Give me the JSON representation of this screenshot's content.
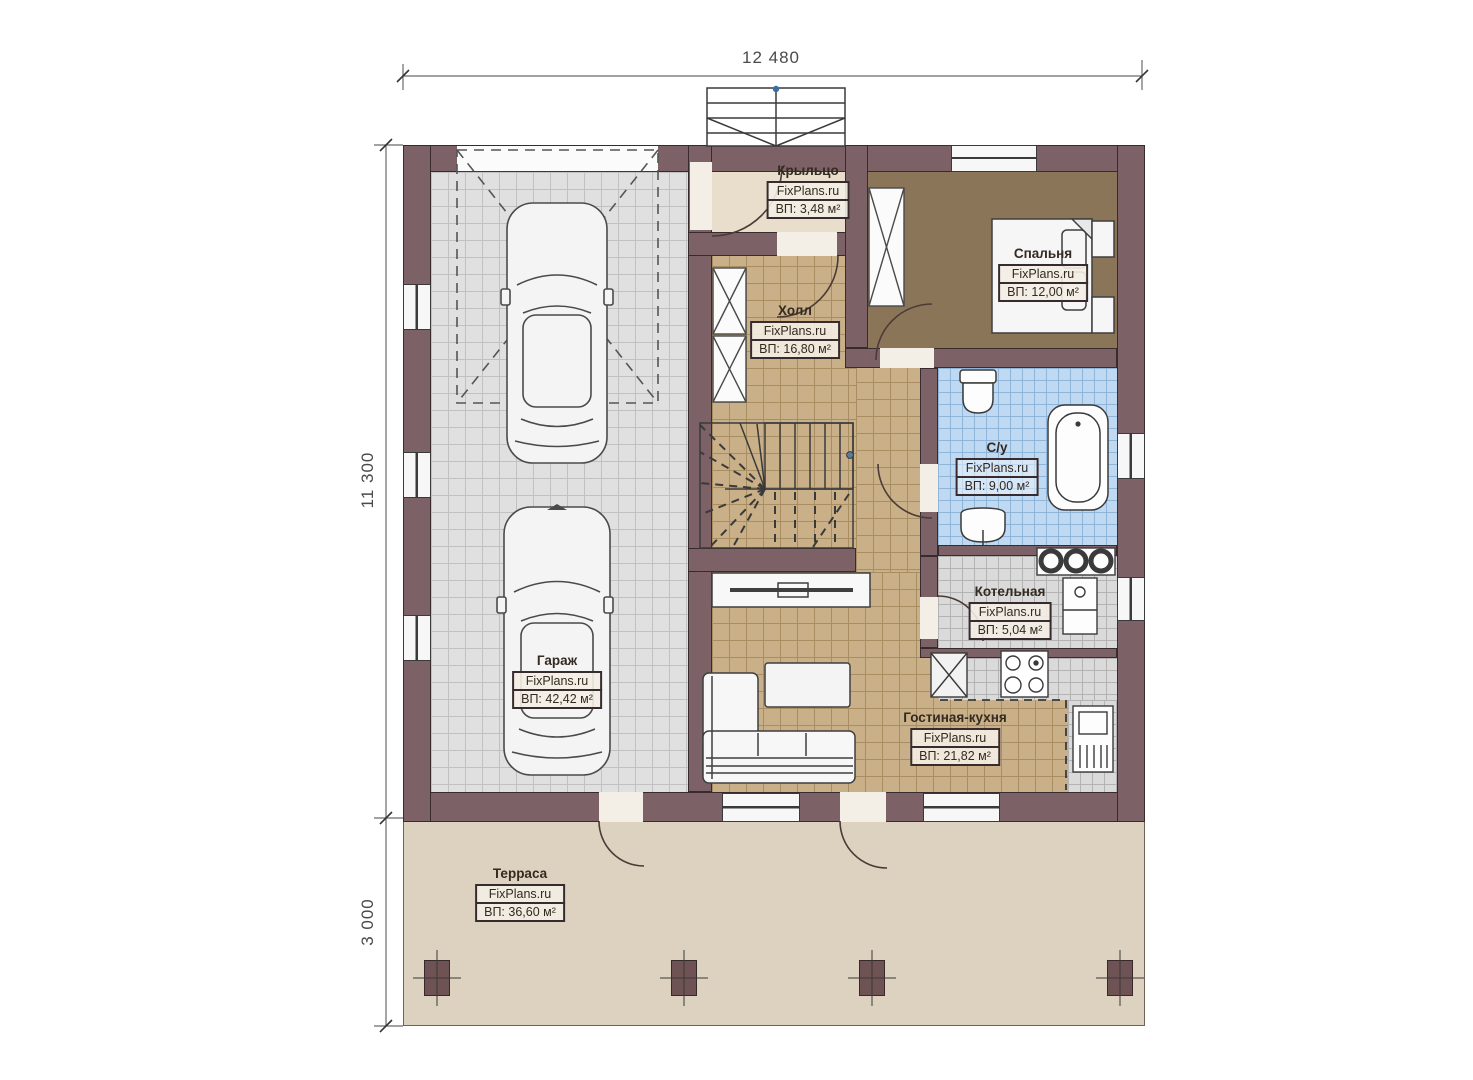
{
  "plan": {
    "brand": "FixPlans.ru",
    "dimensions": {
      "top_width": "12 480",
      "left_height": "11 300",
      "terrace_depth": "3 000"
    },
    "rooms": [
      {
        "key": "porch",
        "name": "Крыльцо",
        "brand": "FixPlans.ru",
        "area": "ВП: 3,48 м²"
      },
      {
        "key": "bedroom",
        "name": "Спальня",
        "brand": "FixPlans.ru",
        "area": "ВП: 12,00 м²"
      },
      {
        "key": "hall",
        "name": "Холл",
        "brand": "FixPlans.ru",
        "area": "ВП: 16,80 м²"
      },
      {
        "key": "bathroom",
        "name": "С/у",
        "brand": "FixPlans.ru",
        "area": "ВП: 9,00 м²"
      },
      {
        "key": "boiler",
        "name": "Котельная",
        "brand": "FixPlans.ru",
        "area": "ВП: 5,04 м²"
      },
      {
        "key": "garage",
        "name": "Гараж",
        "brand": "FixPlans.ru",
        "area": "ВП: 42,42 м²"
      },
      {
        "key": "living_kitchen",
        "name": "Гостиная-кухня",
        "brand": "FixPlans.ru",
        "area": "ВП: 21,82 м²"
      },
      {
        "key": "terrace",
        "name": "Терраса",
        "brand": "FixPlans.ru",
        "area": "ВП: 36,60 м²"
      }
    ],
    "colors": {
      "wall": "#7c6166",
      "wall_outline": "#382b2d",
      "garage_tile": "#e0e0e0",
      "hall_tile": "#cab088",
      "bathroom_tile": "#bfd9f3",
      "utility_tile": "#dadada",
      "bedroom_floor": "#8b7559",
      "porch_floor": "#e8decb",
      "terrace_floor": "#dcd2bf",
      "label_box_bg": "#f3eee4"
    }
  }
}
